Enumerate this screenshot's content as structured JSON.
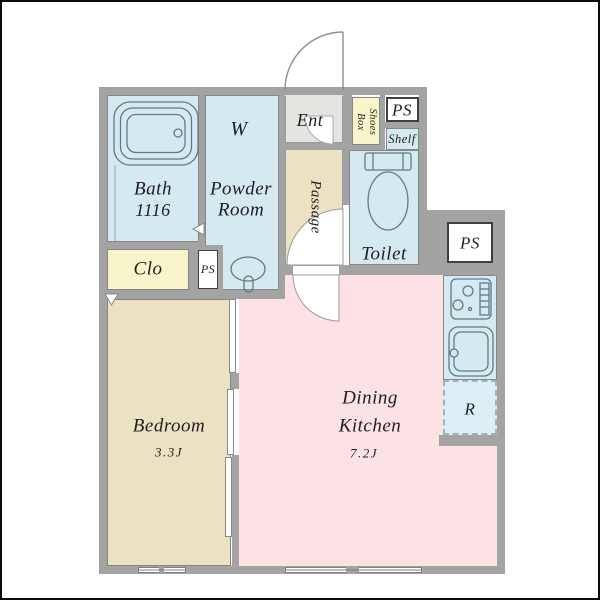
{
  "rooms": {
    "bath": {
      "name": "Bath",
      "size": "1116"
    },
    "powder_room": {
      "line1": "Powder",
      "line2": "Room"
    },
    "entrance": {
      "label": "Ent"
    },
    "passage": {
      "label": "Passage"
    },
    "toilet": {
      "label": "Toilet"
    },
    "bedroom": {
      "name": "Bedroom",
      "area": "3.3J"
    },
    "dining_kitchen": {
      "line1": "Dining",
      "line2": "Kitchen",
      "area": "7.2J"
    },
    "closet": {
      "label": "Clo"
    }
  },
  "features": {
    "washer": "W",
    "shoes_box_line1": "Shoes",
    "shoes_box_line2": "Box",
    "shelf": "Shelf",
    "fridge_space": "R",
    "ps_top": "PS",
    "ps_right": "PS",
    "ps_small": "PS"
  },
  "colors": {
    "wall_gray": "#a3a3a3",
    "wet_area_blue": "#d5eaf0",
    "fridge_blue": "#ddeff6",
    "closet_yellow": "#f9f5cb",
    "floor_beige": "#eae2c2",
    "dining_pink": "#fce1e5",
    "entrance_gray": "#e4e4e1",
    "fixture_outline": "#5d7b87",
    "text": "#1e1e1e"
  }
}
